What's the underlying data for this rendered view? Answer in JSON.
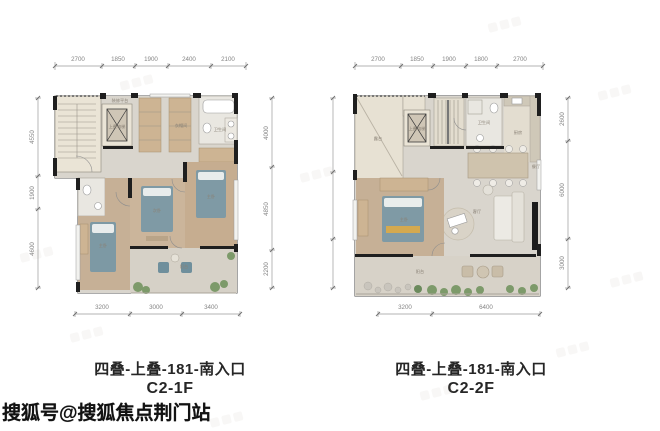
{
  "watermark": {
    "text": "搜狐号@搜狐焦点荆门站"
  },
  "plans": [
    {
      "title_line1": "四叠-上叠-181-南入口",
      "title_line2": "C2-1F",
      "dims_top": [
        "2700",
        "1850",
        "1900",
        "2400",
        "2100"
      ],
      "dims_bottom": [
        "3200",
        "3000",
        "3400"
      ],
      "dims_left": [
        "4550",
        "1900",
        "4600"
      ],
      "dims_right": [
        "4000",
        "4850",
        "2200"
      ],
      "room_labels": {
        "platform": "装修平台",
        "elevator": "上叠电梯",
        "closet": "衣帽间",
        "bath": "卫生间",
        "bedroom_left": "主卧",
        "bedroom_mid": "次卧",
        "bedroom_right": "主卧",
        "balcony": "阳台"
      }
    },
    {
      "title_line1": "四叠-上叠-181-南入口",
      "title_line2": "C2-2F",
      "dims_top": [
        "2700",
        "1850",
        "1900",
        "1800",
        "2700"
      ],
      "dims_bottom": [
        "3200",
        "6400"
      ],
      "dims_left": [
        "4550",
        "4050",
        "3000"
      ],
      "dims_right": [
        "2600",
        "6000",
        "3000"
      ],
      "room_labels": {
        "terrace": "露台",
        "elevator": "上叠电梯",
        "bath": "卫生间",
        "kitchen": "厨房",
        "dining": "餐厅",
        "living": "客厅",
        "bedroom": "主卧",
        "balcony": "阳台"
      }
    }
  ],
  "colors": {
    "wall": "#1f1f1f",
    "floor_hall": "#d9d5cd",
    "floor_wood": "#c7b299",
    "floor_terrace": "#e6e0d3",
    "furniture_blue": "#7d99a4",
    "plant_green": "#7d9a6a",
    "dim_text": "#848484",
    "title_text": "#262626"
  }
}
